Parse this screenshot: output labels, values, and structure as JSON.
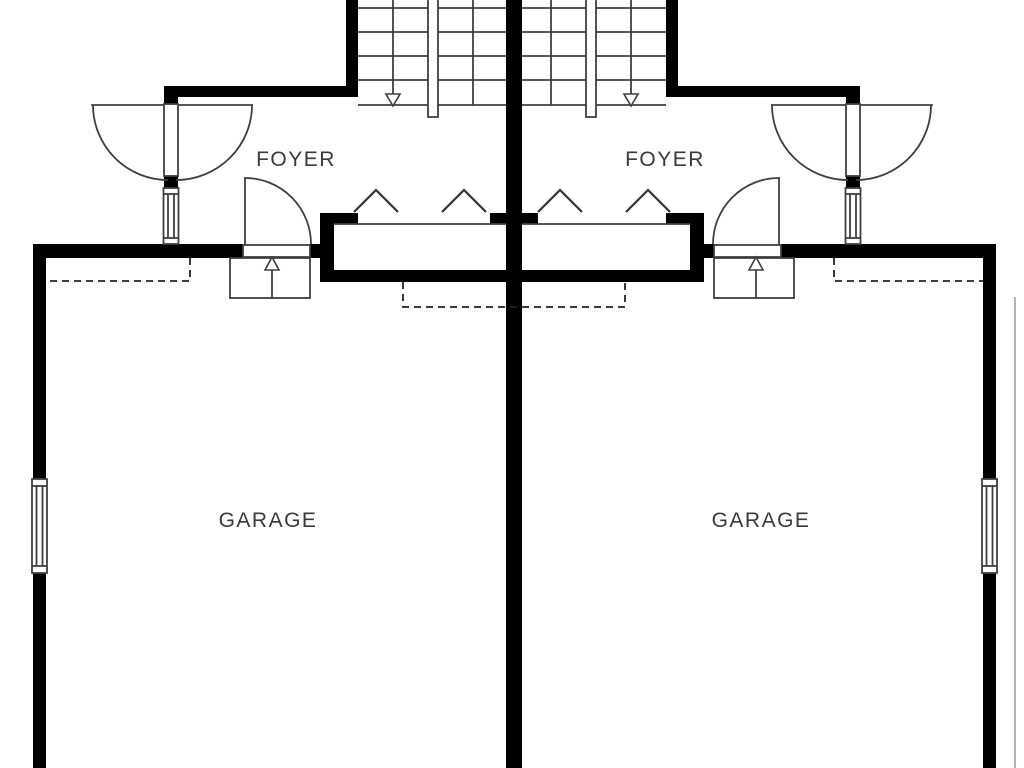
{
  "palette": {
    "background": "#ffffff",
    "wall": "#000000",
    "line": "#3f3f3f",
    "dash": "#222222",
    "text": "#3a3a3a",
    "boundary": "#9a9a9a"
  },
  "plan_title": "Duplex garage level floor plan",
  "rooms": [
    {
      "name": "foyer-left",
      "label": "FOYER"
    },
    {
      "name": "foyer-right",
      "label": "FOYER"
    },
    {
      "name": "garage-left",
      "label": "GARAGE"
    },
    {
      "name": "garage-right",
      "label": "GARAGE"
    }
  ],
  "symbols": {
    "stair_arrow_left": "down-arrow",
    "stair_arrow_right": "down-arrow",
    "step_arrow_left": "up-arrow",
    "step_arrow_right": "up-arrow",
    "closet_doors": "bifold-chevron",
    "overhead_outline": "dashed-rectangle"
  }
}
